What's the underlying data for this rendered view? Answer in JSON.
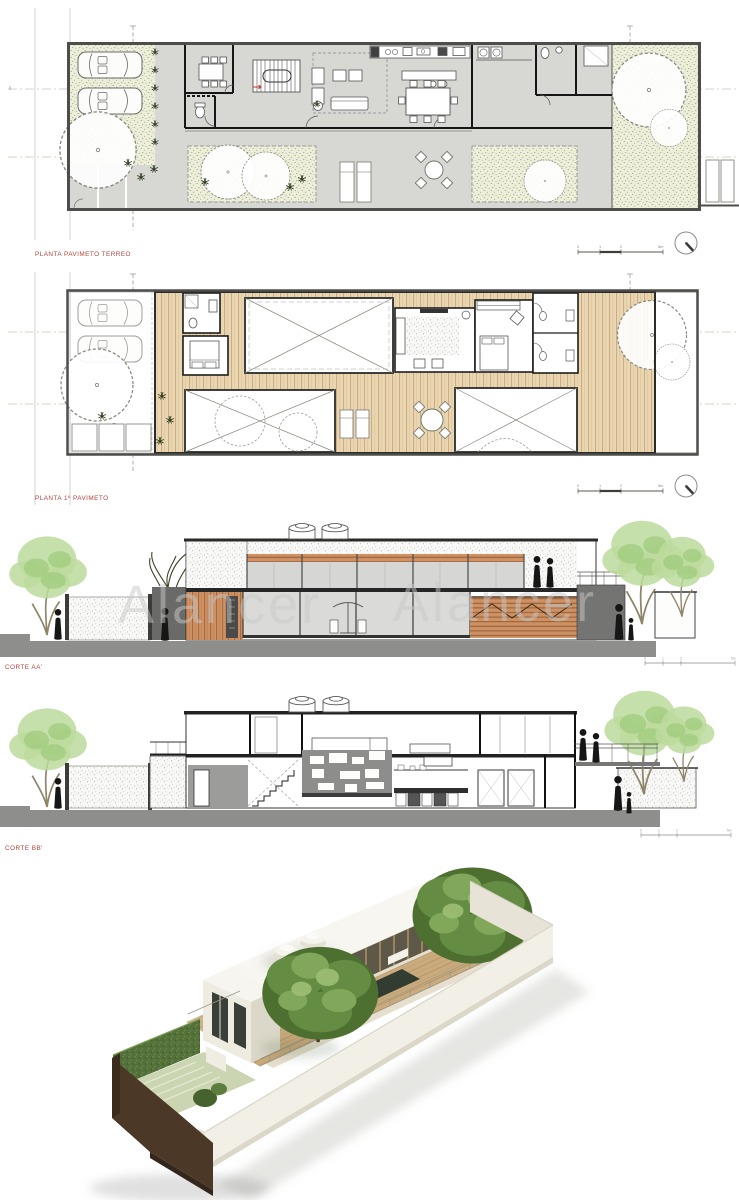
{
  "labels": {
    "plan_ground": "PLANTA PAVIMETO TERREO",
    "plan_first": "PLANTA 1º PAVIMETO",
    "section_aa": "CORTE AA'",
    "section_bb": "CORTE BB'"
  },
  "watermark": {
    "text": "Alancer"
  },
  "scale_bar": {
    "ticks": [
      "0",
      "1",
      "2",
      "5m"
    ]
  },
  "colors": {
    "label_red": "#b1453c",
    "watermark_gray": "#c8c8c8",
    "plan_floor_gray": "#d7d7d3",
    "vegetation_stipple": "#eceeda",
    "wood_deck": "#e9d6b2",
    "wood_slats": "#cd9164",
    "section_ground_gray": "#8e8e8c",
    "foliage_green": "#bcdb9c",
    "render_wall_white": "#f2f0e6",
    "render_earth_brown": "#4b3827",
    "render_deck_tan": "#c9ab7e"
  }
}
